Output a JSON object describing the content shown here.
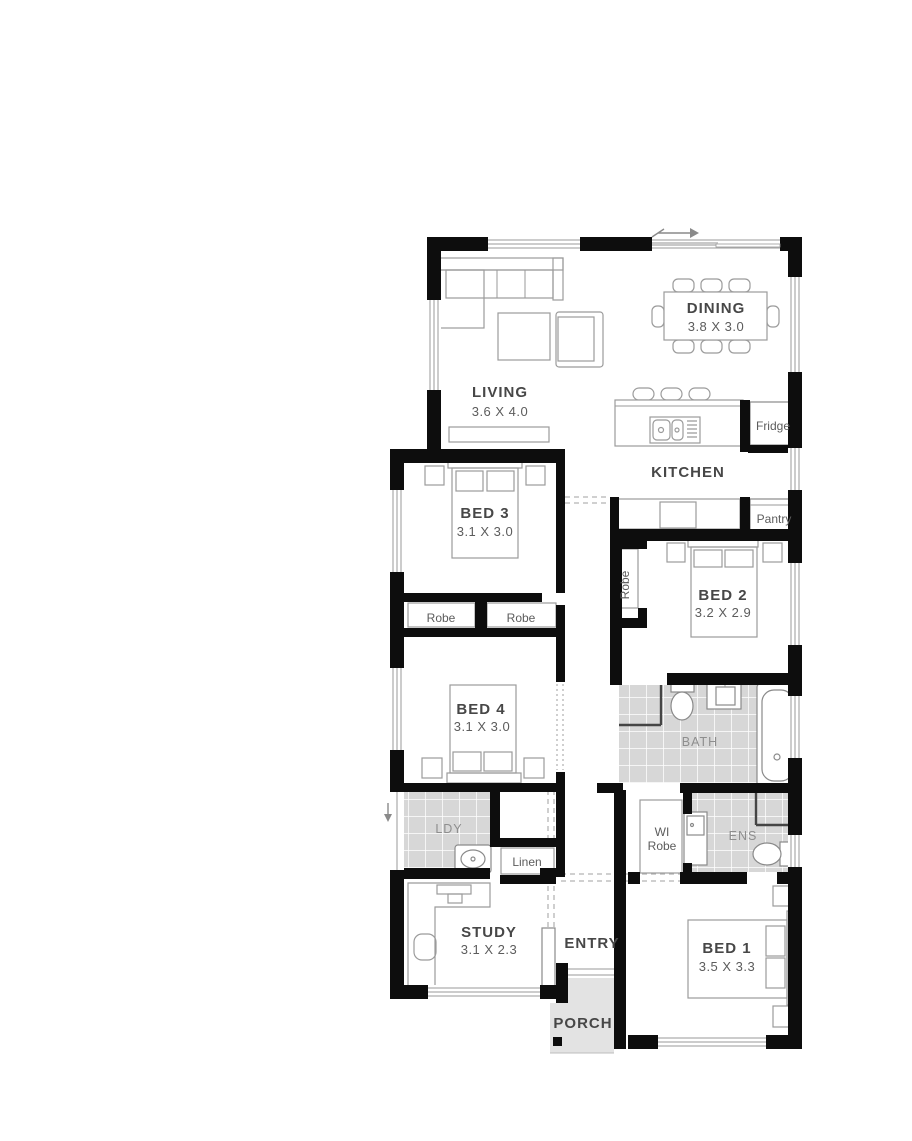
{
  "plan": {
    "rooms": {
      "living": {
        "name": "LIVING",
        "dims": "3.6 X 4.0"
      },
      "dining": {
        "name": "DINING",
        "dims": "3.8 X 3.0"
      },
      "kitchen": {
        "name": "KITCHEN"
      },
      "bed1": {
        "name": "BED 1",
        "dims": "3.5 X 3.3"
      },
      "bed2": {
        "name": "BED 2",
        "dims": "3.2 X 2.9"
      },
      "bed3": {
        "name": "BED 3",
        "dims": "3.1 X 3.0"
      },
      "bed4": {
        "name": "BED 4",
        "dims": "3.1 X 3.0"
      },
      "study": {
        "name": "STUDY",
        "dims": "3.1 X 2.3"
      },
      "bath": {
        "name": "BATH"
      },
      "ens": {
        "name": "ENS"
      },
      "ldy": {
        "name": "LDY"
      },
      "entry": {
        "name": "ENTRY"
      },
      "porch": {
        "name": "PORCH"
      }
    },
    "storage": {
      "fridge": "Fridge",
      "pantry": "Pantry",
      "robe_bed3_left": "Robe",
      "robe_bed3_right": "Robe",
      "robe_bed2": "Robe",
      "linen": "Linen",
      "wi_robe_line1": "WI",
      "wi_robe_line2": "Robe"
    },
    "colors": {
      "wall": "#0d0d0d",
      "tile": "#d7d7d7",
      "porch": "#e3e3e3",
      "label_dark": "#474747",
      "label_light": "#8e8e8e",
      "furniture_outline": "#9b9b9b"
    }
  }
}
